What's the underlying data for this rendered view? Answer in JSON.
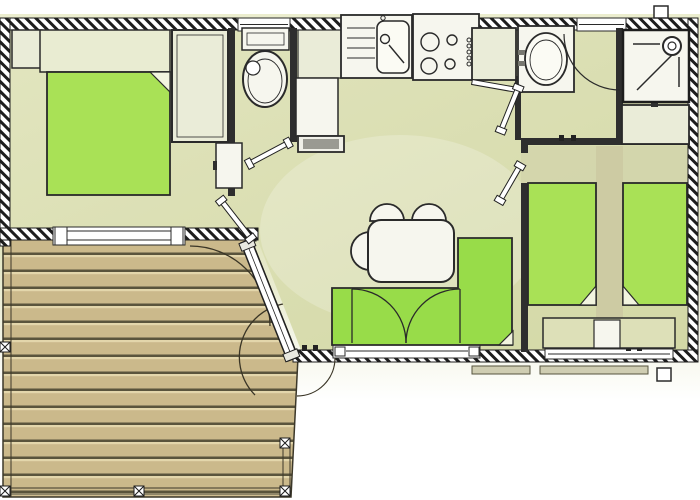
{
  "plan": {
    "kind": "mobile-home-floor-plan",
    "rooms": [
      {
        "name": "master-bedroom",
        "fixtures": [
          "double-bed",
          "pillow-shelf",
          "nightstand",
          "wardrobe",
          "sliding-window"
        ]
      },
      {
        "name": "wc",
        "fixtures": [
          "toilet",
          "cistern",
          "window",
          "door-leaf"
        ]
      },
      {
        "name": "kitchen",
        "fixtures": [
          "sink-unit",
          "drainer",
          "stove-4-burner",
          "counter",
          "counter-end-cap",
          "window"
        ]
      },
      {
        "name": "bathroom",
        "fixtures": [
          "wardrobe",
          "vanity-basin",
          "window",
          "door-swing-arc"
        ]
      },
      {
        "name": "shower-room",
        "fixtures": [
          "shower-tray",
          "shower-head",
          "heater-cabinet"
        ]
      },
      {
        "name": "twin-bedroom",
        "fixtures": [
          "single-bed-left",
          "single-bed-right",
          "bedside-shelf",
          "nightstand",
          "window",
          "door-leaf"
        ]
      },
      {
        "name": "living-dining",
        "fixtures": [
          "dining-table",
          "chair-1",
          "chair-2",
          "chair-3",
          "corner-sofa",
          "french-door-arcs",
          "window"
        ]
      },
      {
        "name": "hallway",
        "fixtures": [
          "hall-cabinet",
          "entrance-door",
          "door-leaf"
        ]
      },
      {
        "name": "deck",
        "fixtures": [
          "wood-planks",
          "railing",
          "posts",
          "door-swing-arcs"
        ]
      }
    ]
  },
  "colors": {
    "wall_dark": "#1d1d1d",
    "outline": "#2a2a2a",
    "floor_a": "#e2e5bf",
    "floor_b": "#d3d8a6",
    "aisle_tan": "#cdcba3",
    "bed_green": "#a9e156",
    "sofa_green": "#98dc49",
    "furniture_white": "#f6f6ee",
    "furniture_cream": "#eaecd8",
    "counter_gray": "#9a9a92",
    "wood": "#cbb98b",
    "wood_line_dark": "#5a543c",
    "wood_line_light": "#e3d6ab",
    "lawn": "#e5e7c5",
    "step_gray": "#cfcdb2"
  }
}
